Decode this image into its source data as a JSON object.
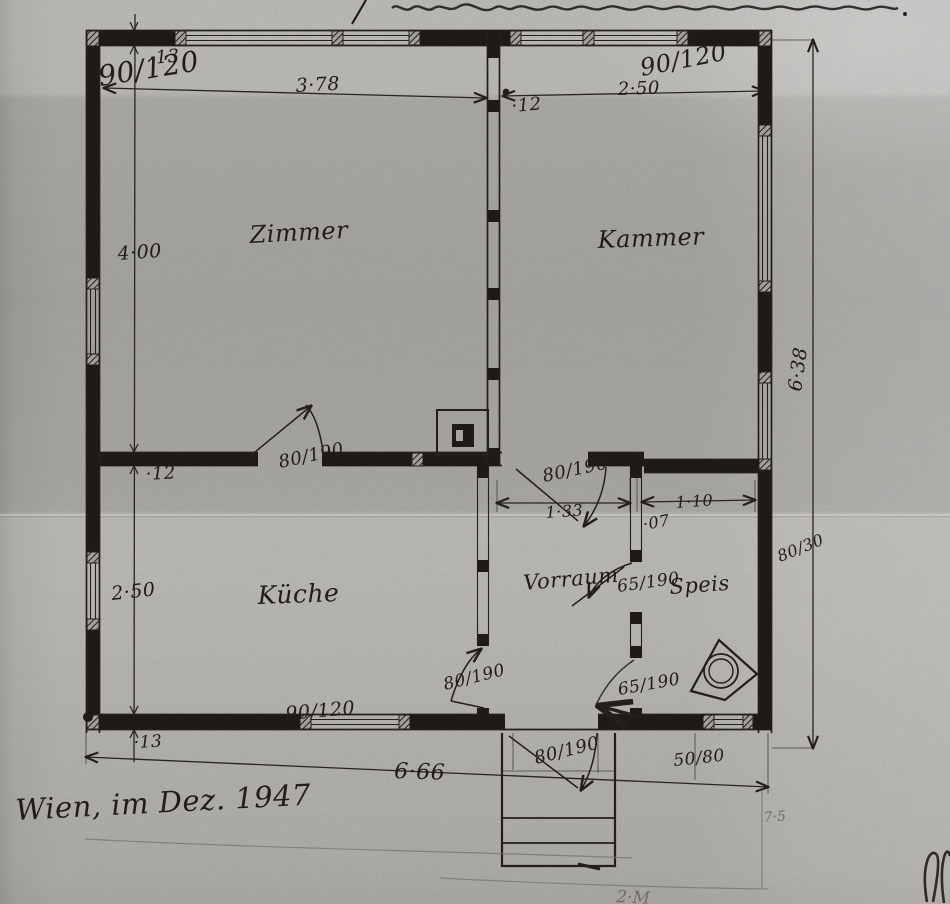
{
  "plan": {
    "rooms": {
      "zimmer": "Zimmer",
      "kammer": "Kammer",
      "kueche": "Küche",
      "vorraum": "Vorraum",
      "speis": "Speis"
    },
    "windows": {
      "top_left": "90/120",
      "top_right": "90/120",
      "bottom_kueche": "90/120",
      "bottom_speis": "50/80",
      "right_small": "80/30"
    },
    "doors": {
      "zimmer": "80/190",
      "vorraum_top": "80/190",
      "speis_upper": "65/190",
      "kueche": "80/190",
      "speis_lower": "65/190",
      "entrance": "80/190"
    },
    "dims": {
      "zimmer_width": "3·78",
      "kammer_width": "2·50",
      "top_wall": "·13",
      "center_wall": "·12",
      "zimmer_depth": "4·00",
      "mid_wall": "·12",
      "kueche_depth": "2·50",
      "bottom_wall": "·13",
      "vorraum_width": "1·33",
      "divider_wall": "·07",
      "speis_width": "1·10",
      "overall_depth": "6·38",
      "overall_width": "6·66",
      "ref_right": "7·5",
      "bottom_fragment": "2·M"
    },
    "signature": "Wien, im Dez. 1947"
  },
  "colors": {
    "ink": "#26231f",
    "pencil": "#85837c",
    "paper": "#c6c4bf"
  }
}
